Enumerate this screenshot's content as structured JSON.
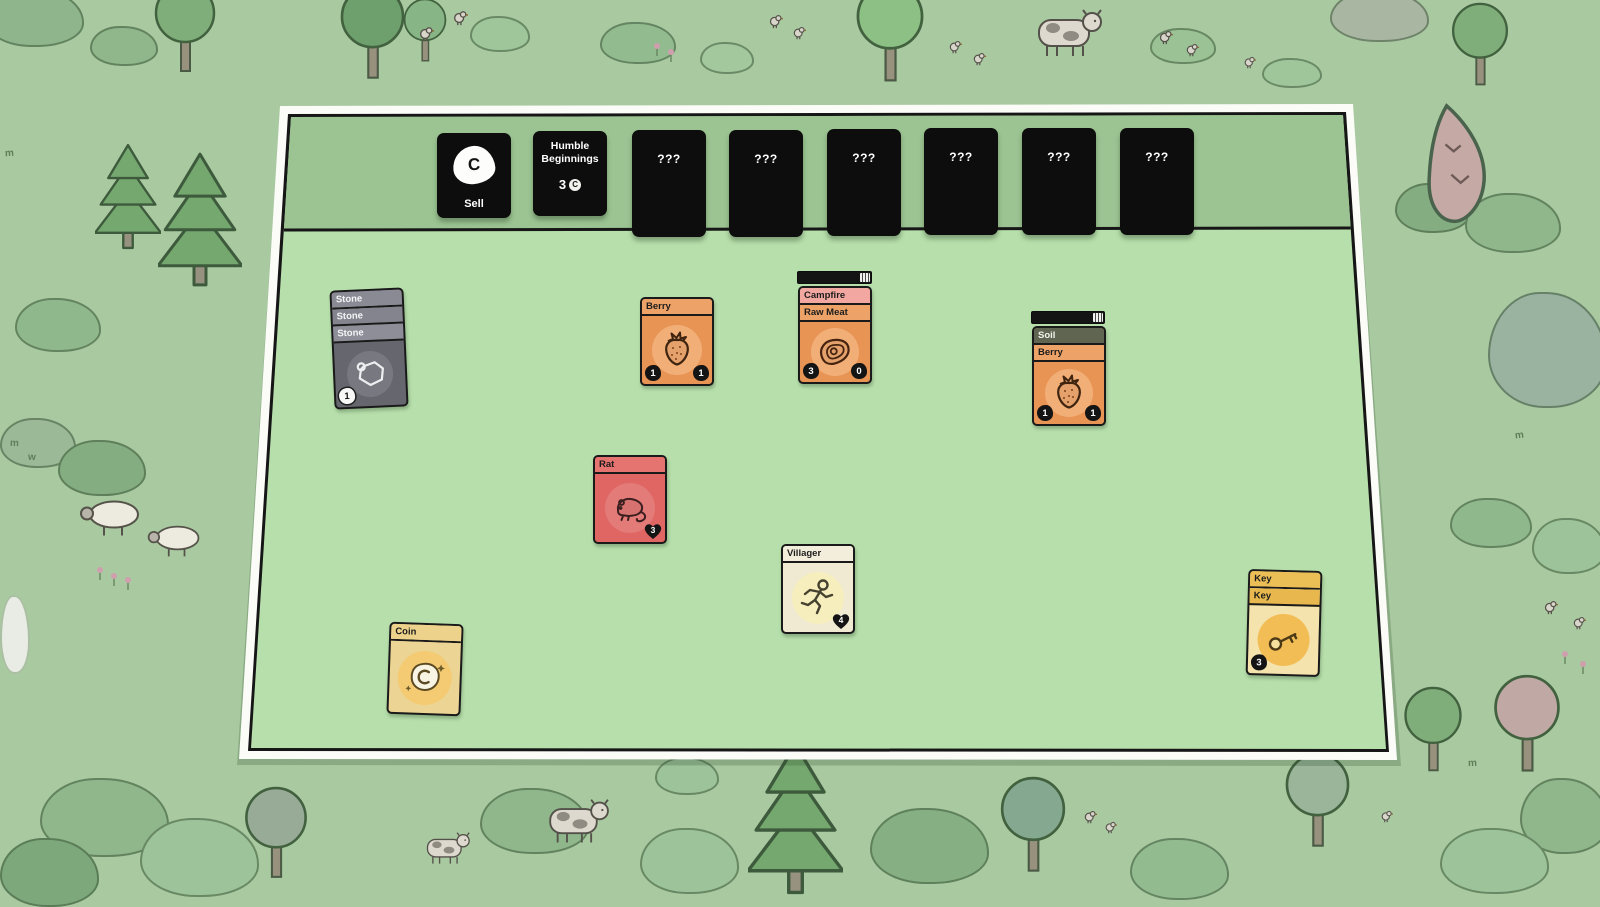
{
  "icons": {
    "coin_letter": "C"
  },
  "palette": {
    "background_green": "#a9caa0",
    "board_green": "#b7dfab",
    "strip_green": "#9cc492",
    "shop_card_black": "#0d0d0d",
    "berry_orange": "#e89455",
    "campfire_pink": "#f2a8a0",
    "soil_olive": "#5f6550",
    "stone_gray": "#66666f",
    "rat_red": "#df6663",
    "villager_cream": "#f0ead3",
    "coin_gold": "#ecd494",
    "key_amber": "#e8b84e"
  },
  "shop_row": {
    "sell_card": {
      "label": "Sell"
    },
    "pack_card": {
      "title": "Humble Beginnings",
      "price": "3"
    },
    "unknown_label": "???"
  },
  "board_cards": {
    "stone_stack": {
      "titles": [
        "Stone",
        "Stone",
        "Stone"
      ],
      "count_badge": "1"
    },
    "berry": {
      "title": "Berry",
      "sell_value": "1",
      "food_value": "1"
    },
    "campfire_stack": {
      "titles": [
        "Campfire",
        "Raw Meat"
      ],
      "sell_value": "3",
      "food_value": "0",
      "has_progress_bar": true
    },
    "soil_stack": {
      "titles": [
        "Soil",
        "Berry"
      ],
      "sell_value": "1",
      "food_value": "1",
      "has_progress_bar": true
    },
    "rat": {
      "title": "Rat",
      "health": "3"
    },
    "villager": {
      "title": "Villager",
      "health": "4"
    },
    "coin": {
      "title": "Coin"
    },
    "key_stack": {
      "titles": [
        "Key",
        "Key"
      ],
      "sell_value": "3"
    }
  }
}
